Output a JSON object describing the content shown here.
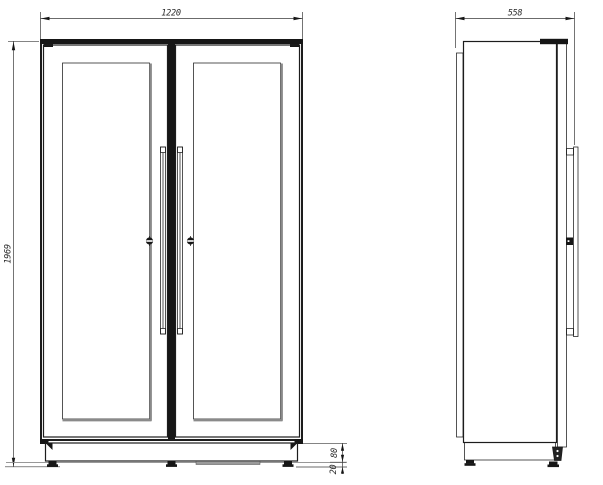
{
  "colors": {
    "line": "#1c1c1c",
    "shadow_gray": "#8a8a8a",
    "background": "#ffffff"
  },
  "dimensions": {
    "width_mm": "1220",
    "height_mm": "1969",
    "depth_mm": "558",
    "plinth_height_mm": "80",
    "foot_height_mm": "20"
  }
}
